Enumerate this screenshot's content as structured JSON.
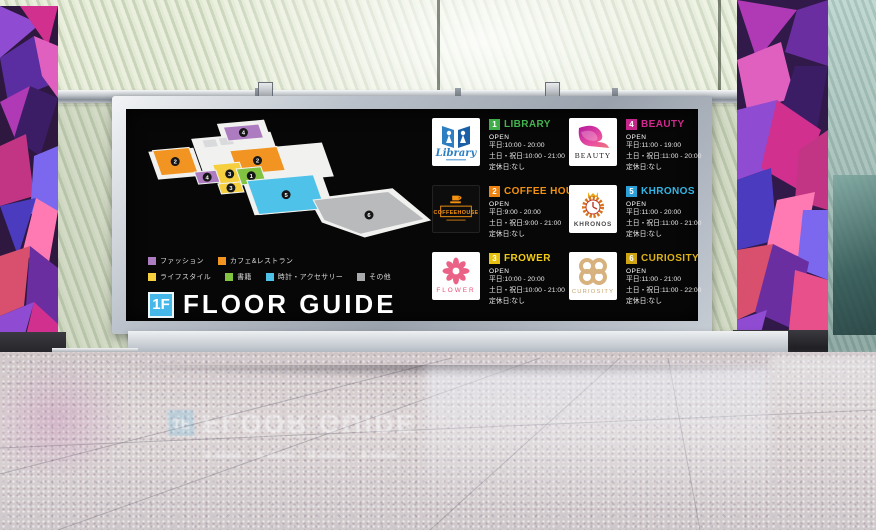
{
  "signboard": {
    "floor_label": "1F",
    "title": "FLOOR GUIDE",
    "accent_blue": "#45b7e8",
    "legend": [
      {
        "label": "ファッション",
        "color": "#ad7cc0"
      },
      {
        "label": "カフェ&レストラン",
        "color": "#f29421"
      },
      {
        "label": "ライフスタイル",
        "color": "#f6cf3f"
      },
      {
        "label": "書籍",
        "color": "#82c341"
      },
      {
        "label": "時計・アクセサリー",
        "color": "#4fc2ea"
      },
      {
        "label": "その他",
        "color": "#a9aaab"
      }
    ],
    "stores": [
      {
        "number": "1",
        "name": "LIBRARY",
        "badge_color": "#3fae49",
        "name_color": "#44b34f",
        "logo_text": "Library",
        "open_label": "OPEN",
        "hours": [
          "平日:10:00 - 20:00",
          "土日・祝日:10:00 - 21:00",
          "定休日:なし"
        ]
      },
      {
        "number": "4",
        "name": "BEAUTY",
        "badge_color": "#c4268b",
        "name_color": "#d0288c",
        "logo_text": "BEAUTY",
        "open_label": "OPEN",
        "hours": [
          "平日:11:00 - 19:00",
          "土日・祝日:11:00 - 20:00",
          "定休日:なし"
        ]
      },
      {
        "number": "2",
        "name": "COFFEE HOUSE",
        "badge_color": "#ef8312",
        "name_color": "#f39111",
        "logo_text": "COFFEEHOUSE",
        "open_label": "OPEN",
        "hours": [
          "平日:9:00 - 20:00",
          "土日・祝日:9:00 - 21:00",
          "定休日:なし"
        ]
      },
      {
        "number": "5",
        "name": "KHRONOS",
        "badge_color": "#2b9fd8",
        "name_color": "#35b5e5",
        "logo_text": "KHRONOS",
        "open_label": "OPEN",
        "hours": [
          "平日:11:00 - 20:00",
          "土日・祝日:11:00 - 21:00",
          "定休日:なし"
        ]
      },
      {
        "number": "3",
        "name": "FROWER",
        "badge_color": "#e8c20e",
        "name_color": "#f2cd13",
        "logo_text": "FLOWER",
        "open_label": "OPEN",
        "hours": [
          "平日:10:00 - 20:00",
          "土日・祝日:10:00 - 21:00",
          "定休日:なし"
        ]
      },
      {
        "number": "6",
        "name": "CURIOSITY",
        "badge_color": "#cfa412",
        "name_color": "#dcb218",
        "logo_text": "CURIOSITY",
        "open_label": "OPEN",
        "hours": [
          "平日:11:00 - 21:00",
          "土日・祝日:11:00 - 22:00",
          "定休日:なし"
        ]
      }
    ],
    "map": {
      "floor_color": "#f1f2f0",
      "table_color": "#d9dadb",
      "whites": [
        [
          4,
          34,
          42,
          28
        ],
        [
          44,
          22,
          74,
          44
        ],
        [
          68,
          8,
          44,
          18
        ],
        [
          114,
          30,
          52,
          34
        ],
        [
          90,
          56,
          74,
          40
        ]
      ],
      "white_custom": "154,78 232,68 268,98 206,114 166,100",
      "tables": [
        [
          54,
          23,
          13,
          8
        ],
        [
          69,
          21,
          13,
          8
        ]
      ],
      "regions": [
        {
          "num": "4",
          "color": "#ad7cc0",
          "q": [
            74,
            11,
            33,
            14
          ]
        },
        {
          "num": "2",
          "color": "#f29421",
          "q": [
            8,
            33,
            34,
            25
          ]
        },
        {
          "num": "2",
          "color": "#f29421",
          "q": [
            80,
            33,
            44,
            24
          ]
        },
        {
          "num": "3",
          "color": "#f6cf3f",
          "q": [
            64,
            46,
            25,
            21
          ]
        },
        {
          "num": "4",
          "color": "#ad7cc0",
          "q": [
            47,
            53,
            20,
            12
          ]
        },
        {
          "num": "1",
          "color": "#82c341",
          "q": [
            86,
            50,
            23,
            16
          ]
        },
        {
          "num": "3",
          "color": "#f6cf3f",
          "q": [
            69,
            64,
            21,
            10
          ]
        },
        {
          "num": "5",
          "color": "#4fc2ea",
          "q": [
            96,
            61,
            62,
            34
          ]
        },
        {
          "num": "6",
          "color": "#b9babc",
          "points": "158,79 228,71 262,97 202,111 168,98",
          "dot": [
            210,
            93
          ]
        }
      ]
    }
  }
}
